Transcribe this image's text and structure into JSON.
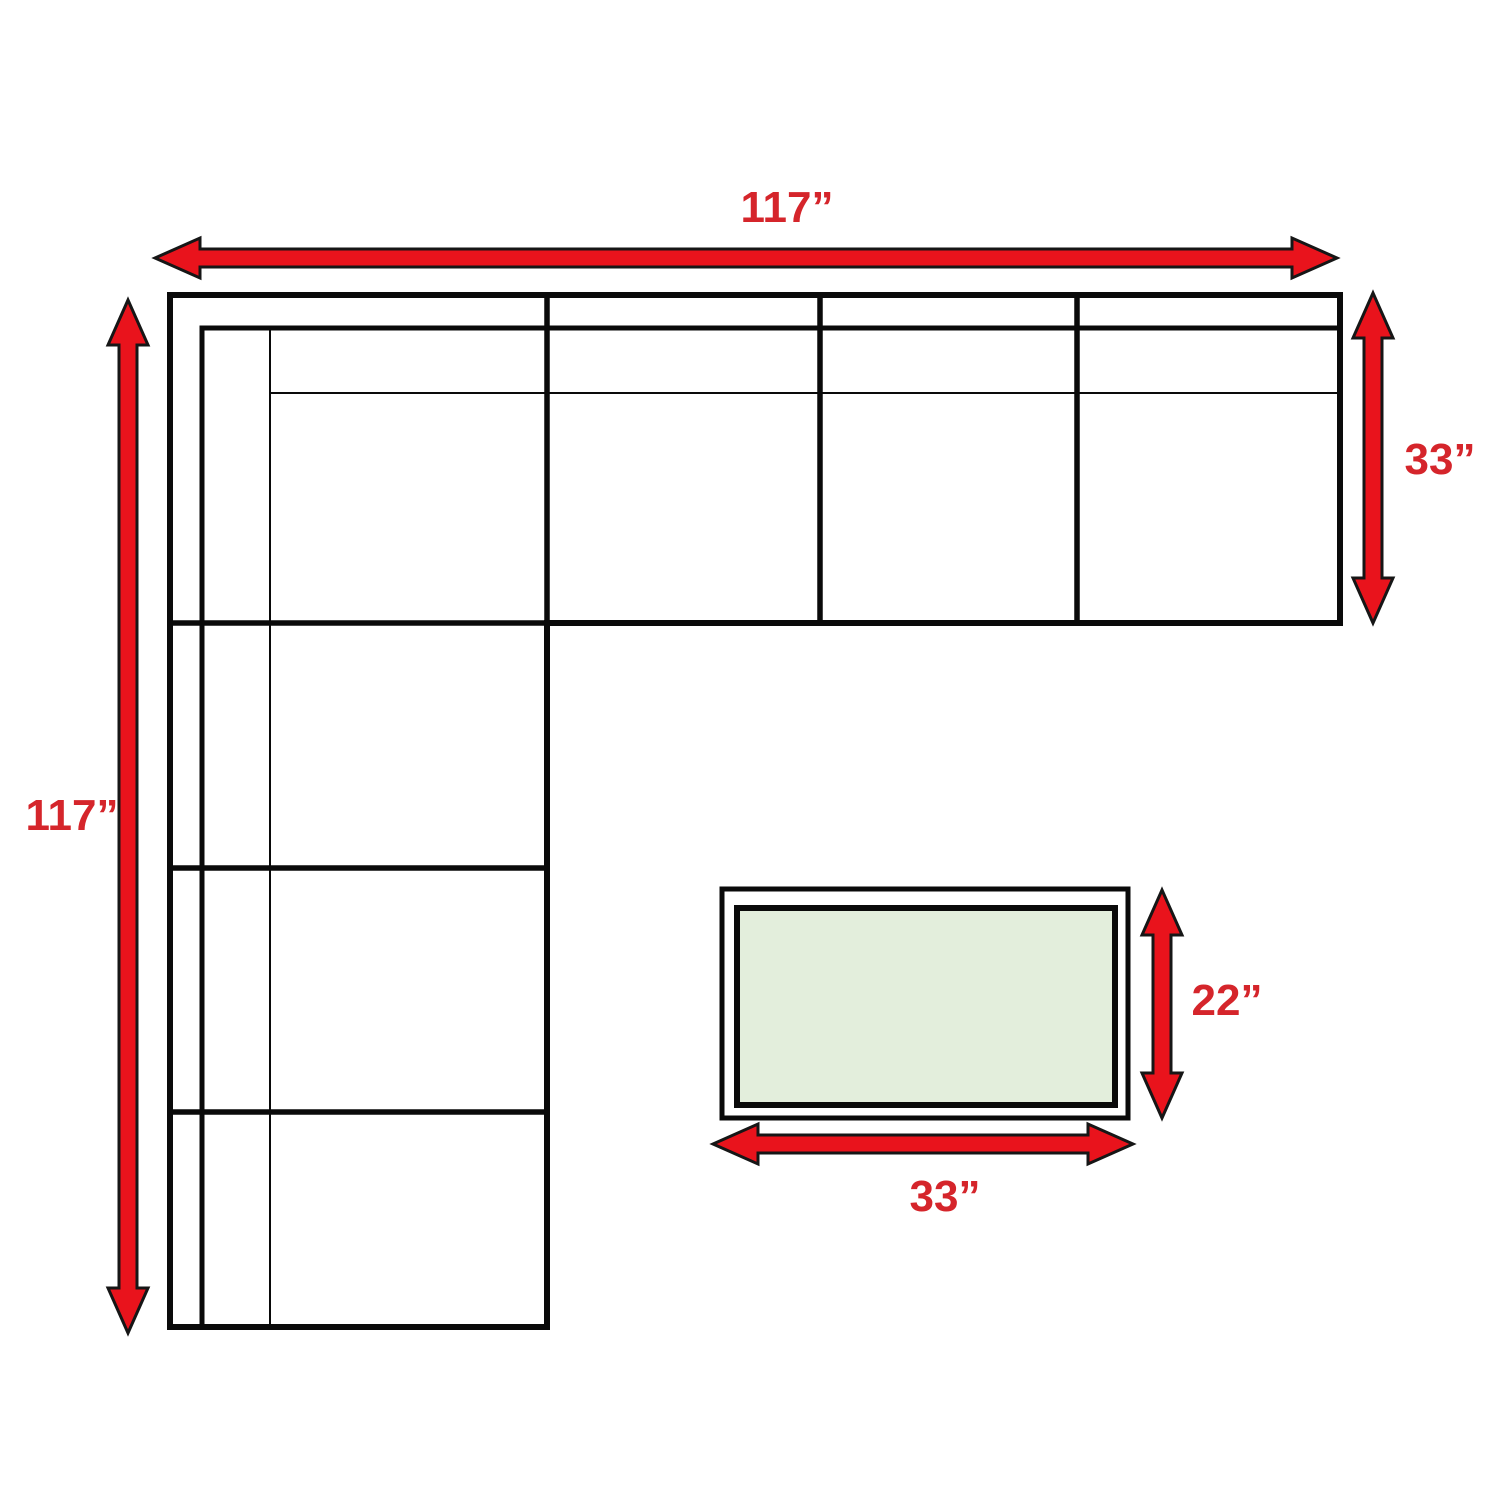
{
  "diagram": {
    "type": "furniture-dimension-diagram",
    "sofa": {
      "width_label": "117”",
      "height_label": "117”",
      "depth_label": "33”"
    },
    "ottoman": {
      "width_label": "33”",
      "height_label": "22”"
    },
    "colors": {
      "arrow_fill": "#e9131c",
      "arrow_outline": "#161616",
      "label_text": "#d5252b",
      "line_black": "#0a0a0a",
      "sofa_fill": "#ffffff",
      "ottoman_fill": "#e3eedc",
      "background": "#ffffff"
    }
  }
}
